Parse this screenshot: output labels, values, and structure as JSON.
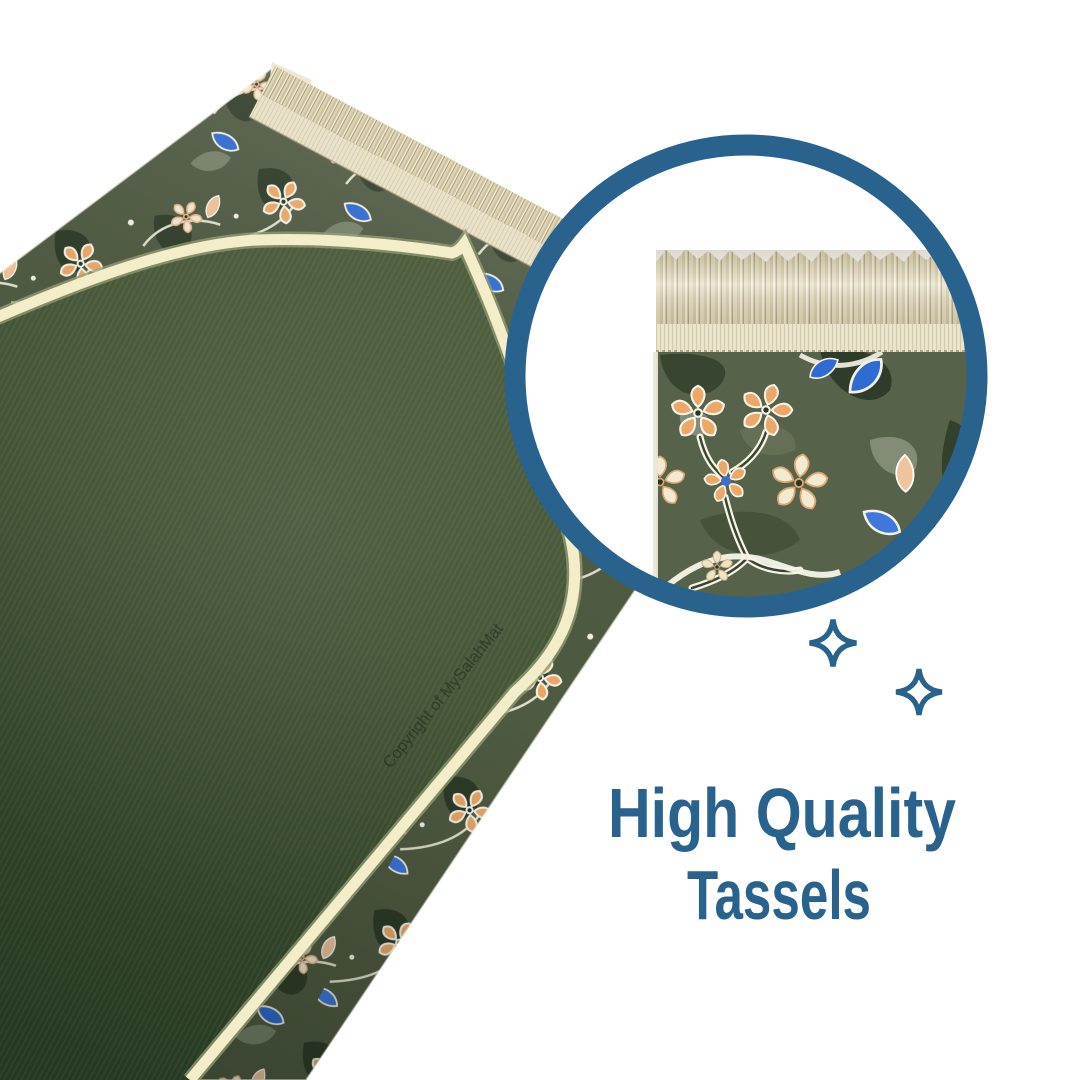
{
  "headline": {
    "line1": "High Quality",
    "line2": "Tassels"
  },
  "watermark": {
    "text": "Copyright of MySalahMat"
  },
  "icons": {
    "callout": "magnifier-circle",
    "decorations": [
      "sparkle-icon",
      "sparkle-icon"
    ]
  },
  "colors": {
    "background": "#ffffff",
    "brand_blue": "#29628d",
    "piping_cream": "#f3edca",
    "fringe_cream": "#ebe3c9",
    "mat_green": "#44563a",
    "mat_green_dark": "#263a23",
    "floral_olive": "#4f5a42",
    "floral_orange": "#eba869",
    "floral_cream": "#f2e8cf",
    "floral_blue": "#2f6bd3"
  }
}
